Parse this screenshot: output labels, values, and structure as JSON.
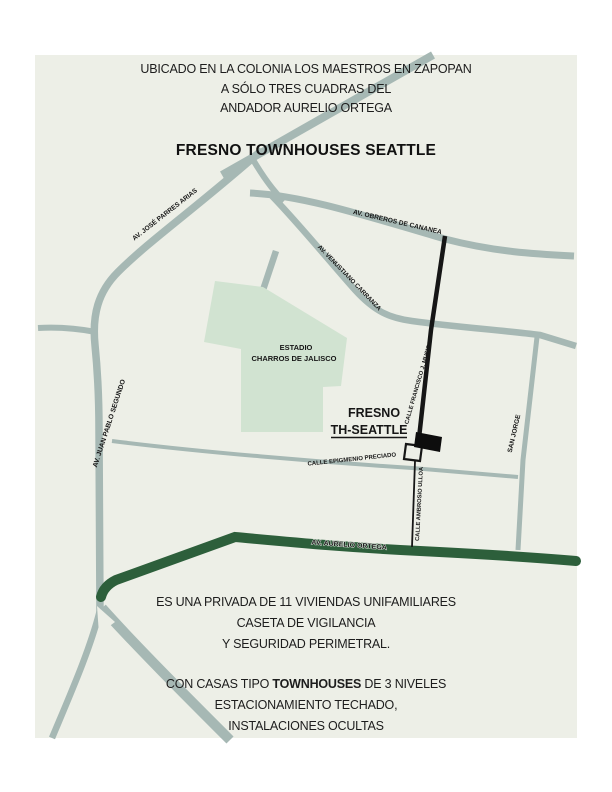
{
  "header": {
    "line1": "UBICADO EN LA COLONIA LOS MAESTROS EN ZAPOPAN",
    "line2": "A  SÓLO TRES CUADRAS DEL",
    "line3": "ANDADOR AURELIO ORTEGA",
    "title": "FRESNO TOWNHOUSES SEATTLE"
  },
  "map": {
    "colors": {
      "background": "#edefe7",
      "road_gray": "#a6b8b4",
      "road_green": "#2d5f3b",
      "road_black": "#161616",
      "stadium_fill": "#d1e3d1",
      "text": "#161616"
    },
    "streets": {
      "parres": "AV. JOSÉ PARRES ARIAS",
      "cananea": "AV. OBREROS DE CANANEA",
      "venustiano": "AV. VENUSTIANO CARRANZA",
      "francisco": "CALLE FRANCISCO J. MUSICA",
      "juan_pablo": "AV. JUAN PABLO SEGUNDO",
      "san_jorge": "SAN JORGE",
      "epigmenio": "CALLE EPIGMENIO PRECIADO",
      "ambrosio": "CALLE AMBROSIO ULLOA",
      "aurelio": "AV. AURELIO ORTEGA"
    },
    "stadium": {
      "line1": "ESTADIO",
      "line2": "CHARROS DE JALISCO"
    },
    "site": {
      "line1": "FRESNO",
      "line2": "TH-SEATTLE"
    }
  },
  "footer": {
    "line1": "ES UNA PRIVADA DE 11 VIVIENDAS UNIFAMILIARES",
    "line2": "CASETA DE VIGILANCIA",
    "line3": "Y SEGURIDAD PERIMETRAL.",
    "line4_prefix": "CON CASAS TIPO ",
    "line4_bold": "TOWNHOUSES",
    "line4_suffix": " DE 3 NIVELES",
    "line5": "ESTACIONAMIENTO TECHADO,",
    "line6": "INSTALACIONES OCULTAS"
  }
}
